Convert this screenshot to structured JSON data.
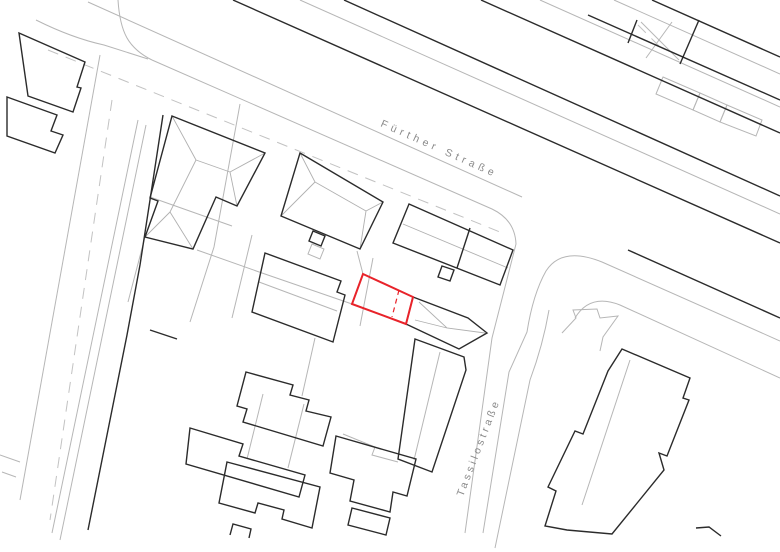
{
  "map": {
    "type": "cadastral-site-plan",
    "background": "#ffffff",
    "colors": {
      "building_outline": "#2b2b2b",
      "parcel_line": "#b6b6b6",
      "dashed_centerline": "#c2c2c2",
      "highlight": "#e8232a",
      "label": "#8a8a8a"
    },
    "labels": {
      "fuerther": "Fürther Straße",
      "tassilo": "Tassilostraße"
    },
    "highlight": {
      "outline": "M 363,274 L 413,297 L 406,324 L 352,304 Z",
      "inner_dashed": "M 399,290 L 392,317"
    },
    "layers": [
      {
        "name": "street-lines",
        "stroke": "#b6b6b6",
        "width": 1,
        "dash": "",
        "paths": [
          "M 88,2 L 522,197",
          "M 36,20 Q 72,38 104,45 L 148,59",
          "M 118,0 C 120,32 128,48 152,60",
          "M 152,60 L 492,209 Q 515,220 516,244 L 492,338 L 465,533",
          "M 780,341 L 602,262 Q 562,246 546,271 Q 533,294 527,332 L 509,372 L 483,533",
          "M 549,310 Q 543,345 530,380 L 495,548",
          "M 780,378 L 620,305 Q 590,293 575,318",
          "M 300,0 L 780,214",
          "M 540,0 L 780,107",
          "M 614,0 L 780,74",
          "M 663,77 L 700,93 L 693,110 L 656,94 Z",
          "M 700,93 L 727,105 L 720,122 L 693,110 Z",
          "M 727,105 L 762,120 L 756,136 L 720,122 Z",
          "M 641,22 L 679,60",
          "M 672,22 L 646,58",
          "M 100,55 L 20,500",
          "M 138,120 L 52,533",
          "M 146,125 L 60,540",
          "M 0,455 L 20,462 M 2,472 L 16,477"
        ]
      },
      {
        "name": "parcel-lines",
        "stroke": "#b6b6b6",
        "width": 1,
        "dash": "",
        "paths": [
          "M 240,104 L 214,247 L 190,322",
          "M 197,250 L 262,273 L 352,304",
          "M 150,197 L 232,226",
          "M 252,235 L 232,318",
          "M 363,274 L 357,251",
          "M 373,258 L 360,326",
          "M 315,338 L 302,396",
          "M 343,434 L 375,447 L 372,455 L 398,462",
          "M 263,394 L 247,459",
          "M 304,404 L 288,468",
          "M 145,237 L 128,302",
          "M 562,333 L 576,318 L 573,310 L 597,309 L 600,318 L 618,316 L 603,337 L 600,351",
          "M 630,360 L 582,505",
          "M 440,352 L 414,460",
          "M 259,282 L 337,311",
          "M 312,244 L 324,249 L 320,259 L 308,254 Z"
        ]
      },
      {
        "name": "roof-ridge-lines",
        "stroke": "#b0b0b0",
        "width": 0.9,
        "dash": "",
        "paths": [
          "M 172,116 L 196,160 M 265,153 L 230,172 M 196,160 L 230,172 M 196,160 L 170,212 M 145,237 L 170,212 M 193,249 L 170,212 M 237,206 L 230,172",
          "M 300,153 L 315,182 M 281,216 L 315,182 M 315,182 L 366,211 M 383,202 L 366,211 M 360,249 L 366,211",
          "M 403,224 L 508,268",
          "M 419,302 L 447,328 L 485,333 M 447,328 L 415,320"
        ]
      },
      {
        "name": "dashed-centerlines",
        "stroke": "#c2c2c2",
        "width": 1,
        "dash": "11,8",
        "paths": [
          "M 48,50 L 500,232",
          "M 112,100 L 50,520",
          "M 638,25 L 662,49"
        ]
      },
      {
        "name": "buildings",
        "stroke": "#2b2b2b",
        "width": 1.4,
        "dash": "",
        "paths": [
          "M 233,0 L 780,243",
          "M 344,0 L 780,196",
          "M 481,0 L 780,133",
          "M 588,15 L 780,100",
          "M 652,0 L 780,57",
          "M 637,20 L 628,43",
          "M 699,20 L 680,64",
          "M 628,250 L 780,318",
          "M 19,33 L 85,62 L 77,87 L 81,88 L 73,112 L 28,96 Z",
          "M 7,97 L 57,115 L 51,131 L 63,135 L 55,153 L 7,136 Z",
          "M 172,116 L 265,153 L 237,206 L 216,197 L 193,249 L 145,237 L 158,201 L 150,198 Z",
          "M 300,153 L 383,202 L 360,249 L 281,216 Z",
          "M 313,231 L 325,236 L 321,246 L 309,241 Z",
          "M 409,204 L 513,250 L 500,285 L 393,243 Z",
          "M 470,228 L 457,268",
          "M 442,266 L 454,270 L 450,281 L 438,277 Z",
          "M 265,253 L 341,281 L 337,292 L 345,295 L 333,342 L 252,312 Z",
          "M 413,297 L 468,318 L 487,333 L 459,349 L 406,324 Z",
          "M 415,339 L 464,357 L 466,370 L 432,472 L 398,459 Z",
          "M 163,115 L 150,200 L 140,265 L 127,335 L 108,430 L 88,530",
          "M 150,330 L 177,339",
          "M 246,372 L 293,385 L 290,395 L 309,400 L 306,411 L 331,417 L 323,446 L 243,422 L 247,409 L 237,406 Z",
          "M 190,428 L 243,444 L 239,456 L 305,475 L 299,497 L 186,464 Z",
          "M 227,462 L 320,487 L 312,528 L 282,519 L 284,510 L 258,503 L 255,513 L 219,503 Z",
          "M 336,436 L 416,459 L 407,496 L 393,492 L 390,512 L 350,501 L 354,480 L 330,473 Z",
          "M 352,508 L 390,518 L 386,535 L 348,525 Z",
          "M 230,535 L 233,524 L 251,529 L 249,538",
          "M 622,349 L 690,378 L 683,398 L 689,400 L 667,456 L 659,453 L 664,470 L 612,534 L 567,530 L 545,526 L 556,491 L 548,487 L 575,431 L 583,434 L 608,371 Z",
          "M 696,528 L 709,527 L 721,536"
        ]
      }
    ]
  }
}
